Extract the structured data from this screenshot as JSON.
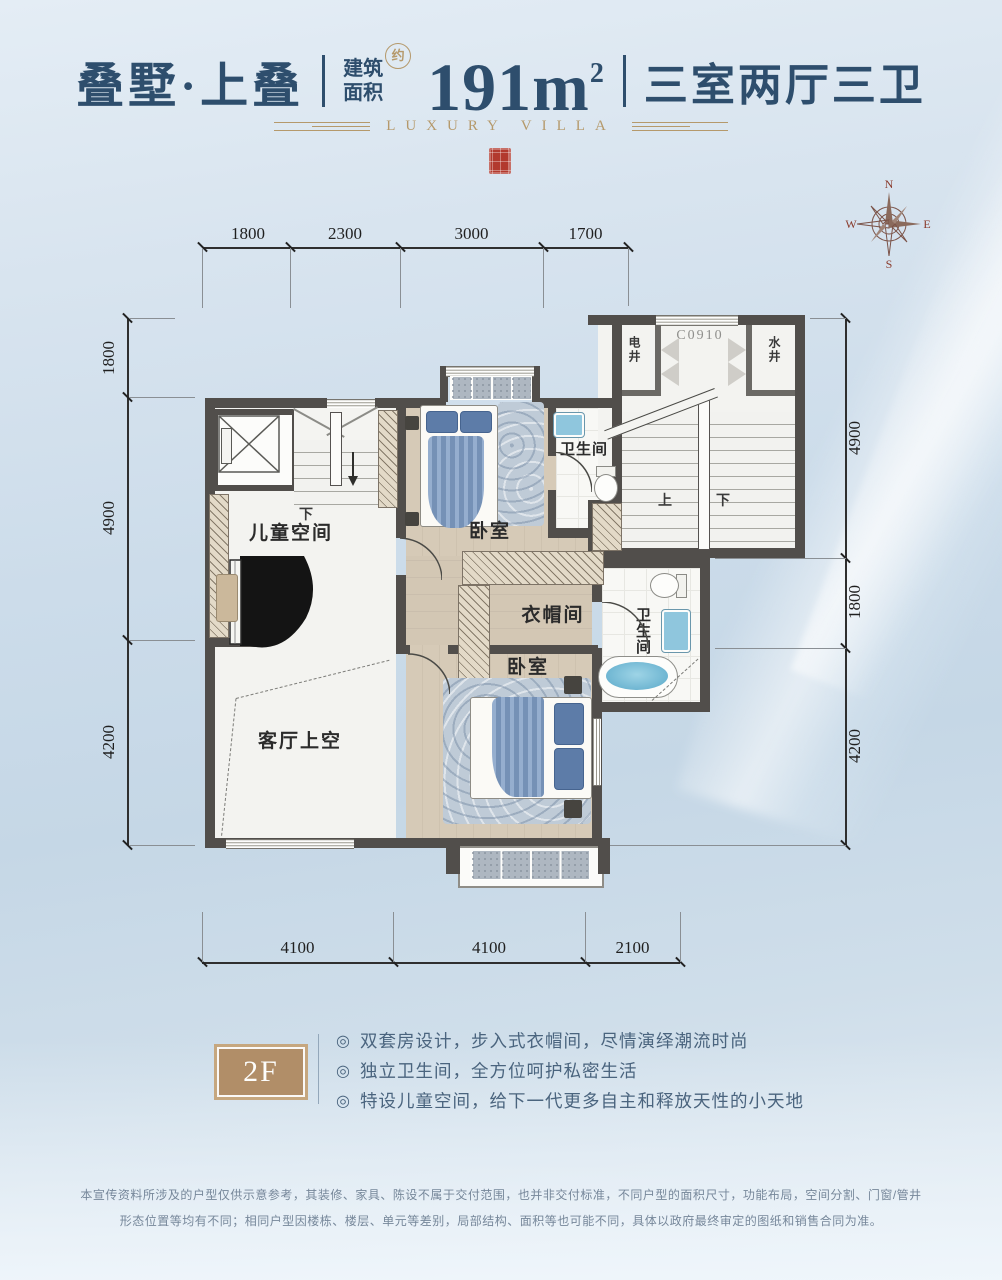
{
  "header": {
    "title": "叠墅·上叠",
    "area_label_top": "建筑",
    "area_label_bottom": "面积",
    "approx": "约",
    "area_value": "191m",
    "area_sup": "2",
    "layout": "三室两厅三卫",
    "subtitle": "LUXURY VILLA"
  },
  "compass": {
    "n": "N",
    "e": "E",
    "s": "S",
    "w": "W"
  },
  "dims": {
    "top": [
      "1800",
      "2300",
      "3000",
      "1700"
    ],
    "bottom": [
      "4100",
      "4100",
      "2100"
    ],
    "left": [
      "1800",
      "4900",
      "4200"
    ],
    "right": [
      "4900",
      "1800",
      "4200"
    ]
  },
  "plan": {
    "window_code": "C0910",
    "electric_shaft": "电井",
    "water_shaft": "水井",
    "stair_up": "上",
    "stair_down": "下",
    "unit_stair_down": "下",
    "children_space": "儿童空间",
    "living_void": "客厅上空",
    "bedroom1": "卧室",
    "bedroom2": "卧室",
    "bathroom1": "卫生间",
    "bathroom2": "卫生间",
    "cloakroom": "衣帽间"
  },
  "floor": {
    "badge": "2F"
  },
  "features": {
    "bullet": "◎",
    "items": [
      "双套房设计，步入式衣帽间，尽情演绎潮流时尚",
      "独立卫生间，全方位呵护私密生活",
      "特设儿童空间，给下一代更多自主和释放天性的小天地"
    ]
  },
  "disclaimer": [
    "本宣传资料所涉及的户型仅供示意参考，其装修、家具、陈设不属于交付范围，也并非交付标准，不同户型的面积尺寸，功能布局，空间分割、门窗/管井",
    "形态位置等均有不同；相同户型因楼栋、楼层、单元等差别，局部结构、面积等也可能不同，具体以政府最终审定的图纸和销售合同为准。"
  ],
  "colors": {
    "title_blue": "#2e4e6d",
    "gold": "#b5996b",
    "seal_red": "#b23a2e",
    "wall": "#514e4b",
    "fixture_blue": "#8fc6dd",
    "bed_blue": "#7e9cc4",
    "badge_tan": "#b18e68"
  }
}
